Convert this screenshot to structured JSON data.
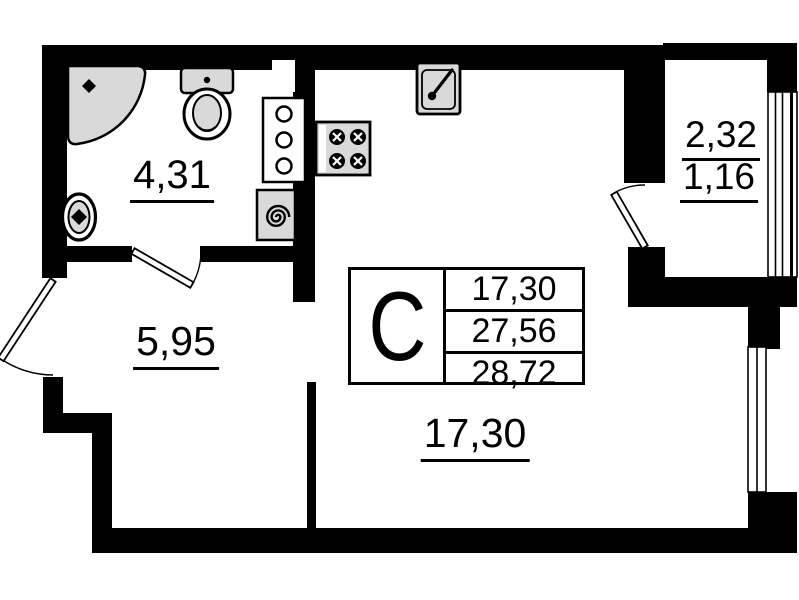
{
  "title": "Studio apartment floor plan",
  "colors": {
    "wall": "#000000",
    "background": "#ffffff",
    "fixture_fill": "#d9d9d9",
    "line": "#000000"
  },
  "unit_card": {
    "letter": "С",
    "areas": [
      "17,30",
      "27,56",
      "28,72"
    ]
  },
  "room_labels": {
    "bathroom": "4,31",
    "hallway": "5,95",
    "living_room": "17,30",
    "balcony_total": "2,32",
    "balcony_reduced": "1,16"
  }
}
